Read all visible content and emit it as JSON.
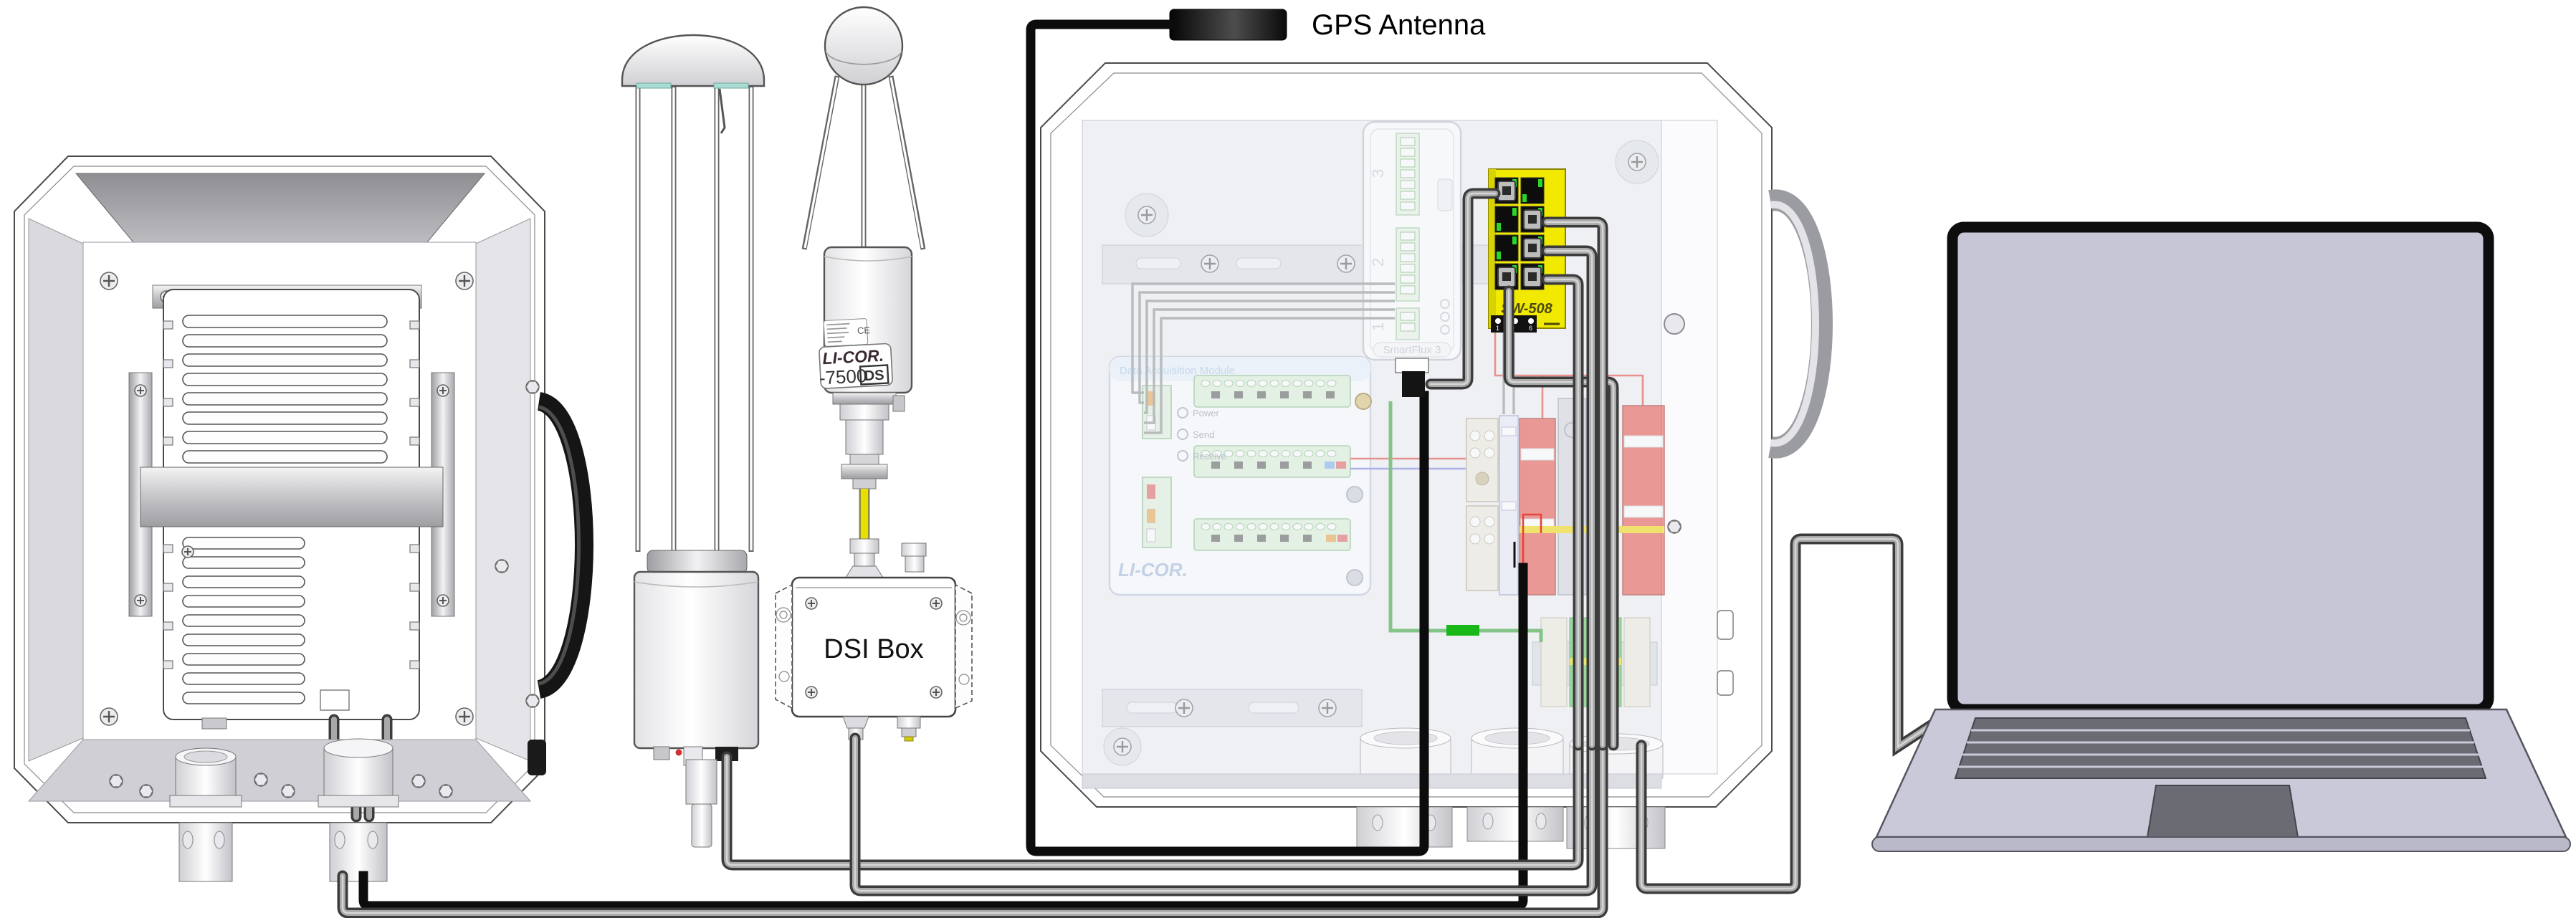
{
  "diagram_title": "Eddy covariance system wiring overview",
  "gps": {
    "label": "GPS Antenna",
    "cable_color": "#0c0c0c"
  },
  "dsi_box": {
    "label": "DSI Box"
  },
  "analyzer": {
    "brand": "LI-COR.",
    "model": "-7500",
    "badge": "DS",
    "ce_mark": "CE"
  },
  "ethernet_switch": {
    "model": "SW-508",
    "dip_labels": [
      "1",
      "2",
      "6"
    ],
    "body_color": "#f2e900",
    "port_led_color": "#2cd42c"
  },
  "smartflux": {
    "label": "SmartFlux 3",
    "port_numbers": [
      "3",
      "2",
      "1"
    ]
  },
  "dam": {
    "title": "Data Acquisition Module",
    "logo": "LI-COR.",
    "leds": [
      "Power",
      "Send",
      "Receive"
    ]
  },
  "colors": {
    "signal_cable_gray": "#a9a9a9",
    "power_cable_black": "#0c0c0c",
    "analyzer_cable_yellow": "#e8df00",
    "terminal_red": "#e8504a",
    "terminal_green": "#58c858",
    "ground_green": "#18b818",
    "licor_blue": "#9fc0e0"
  },
  "components": [
    "electronics enclosure",
    "sonic anemometer",
    "gas analyzer LI-7500DS",
    "DSI interface box",
    "GPS antenna",
    "main system enclosure",
    "ethernet switch SW-508",
    "SmartFlux 3 module",
    "data acquisition module",
    "laptop"
  ]
}
